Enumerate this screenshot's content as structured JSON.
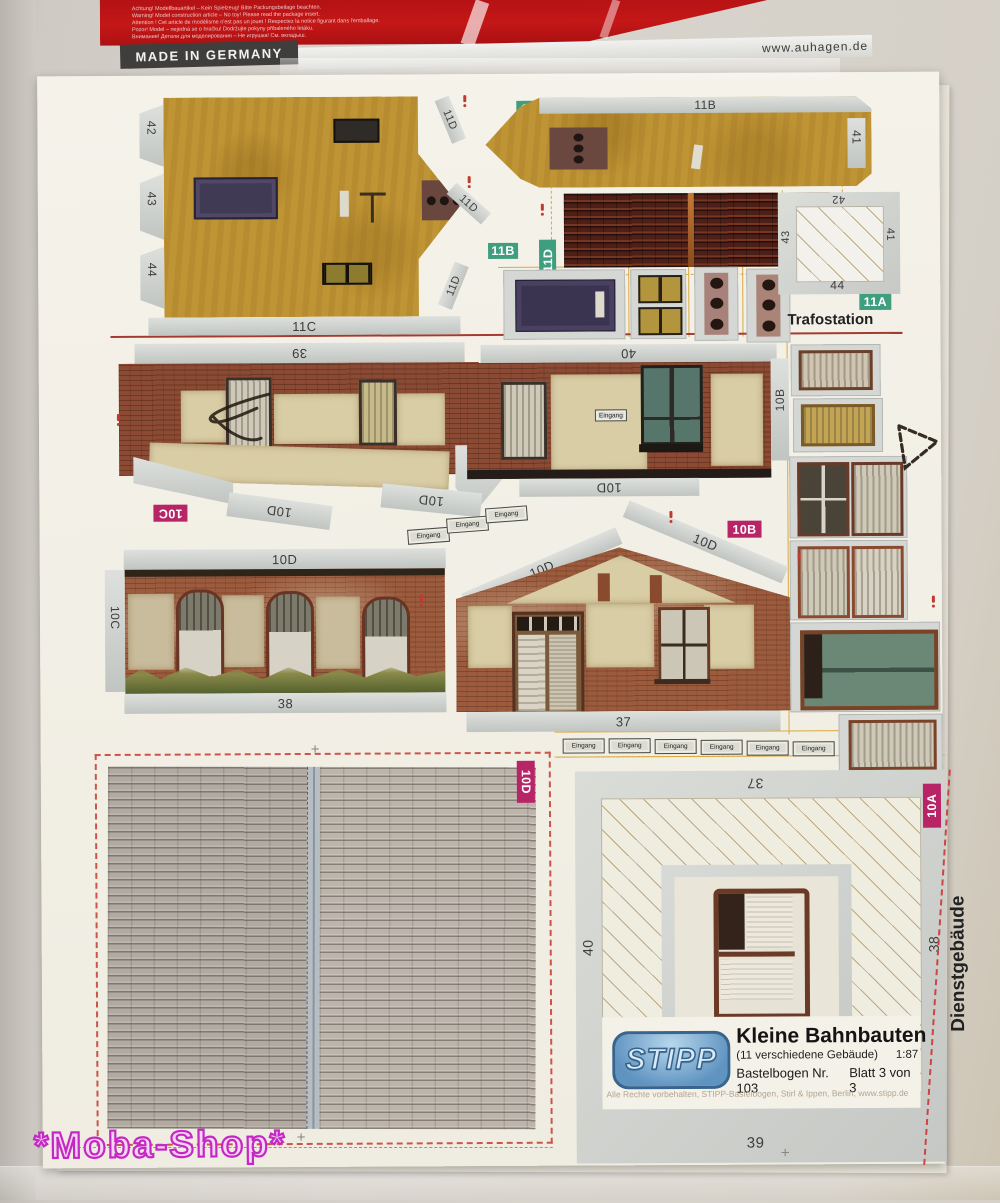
{
  "header": {
    "warning_lines": [
      "Achtung! Modellbauartikel – Kein Spielzeug! Bitte Packungsbeilage beachten.",
      "Warning! Model construction article – No toy! Please read the package insert.",
      "Attention ! Cet article de modélisme n'est pas un jouet ! Respectez la notice figurant dans l'emballage.",
      "Pozor! Model – nejedná se o hračku! Dodržujte pokyny přibaleného letáku.",
      "Внимание! Детали для моделирования – Не игрушка! См. вкладыш."
    ],
    "made_in": "MADE IN GERMANY",
    "website": "www.auhagen.de"
  },
  "labels": {
    "n37": "37",
    "n38": "38",
    "n39": "39",
    "n40": "40",
    "n41": "41",
    "n42": "42",
    "n43": "43",
    "n44": "44",
    "p10A": "10A",
    "p10B": "10B",
    "p10C": "10C",
    "p10D": "10D",
    "p11A": "11A",
    "p11B": "11B",
    "p11C": "11C",
    "p11D": "11D"
  },
  "texts": {
    "trafostation": "Trafostation",
    "dienstgebaeude": "Dienstgebäude",
    "eingang": "Eingang"
  },
  "brand": {
    "logo": "STIPP",
    "title": "Kleine Bahnbauten",
    "subtitle": "(11 verschiedene Gebäude)",
    "scale": "1:87",
    "series": "Bastelbogen Nr. 103",
    "sheet_no": "Blatt 3 von 3",
    "rights": "Alle Rechte vorbehalten, STIPP-Bastelbogen, Stirl & Ippen, Berlin, www.stipp.de"
  },
  "watermark": "*Moba-Shop*",
  "colors": {
    "badge_green": "#3f9e7d",
    "badge_magenta": "#b72567",
    "header_red": "#c41717",
    "watermark_magenta": "#c428c4"
  }
}
